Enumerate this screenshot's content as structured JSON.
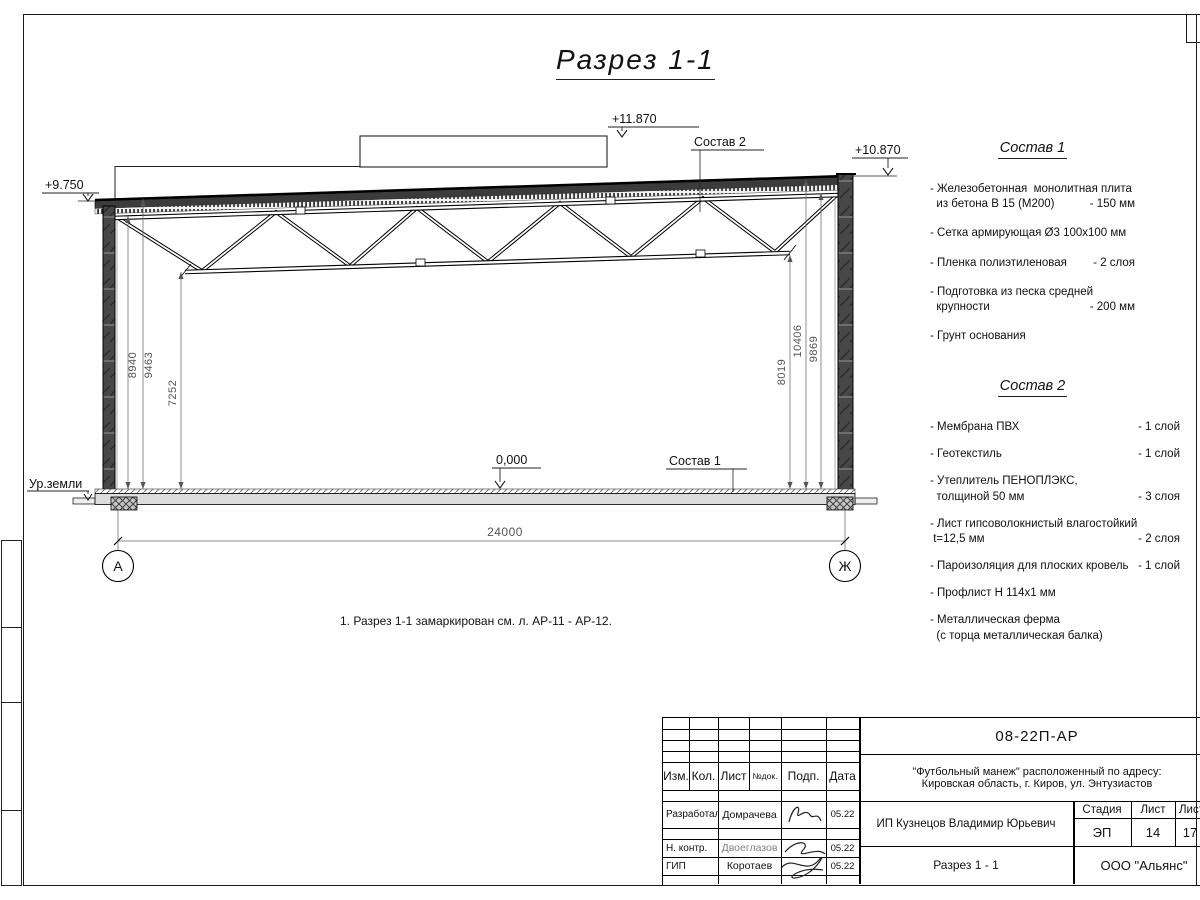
{
  "title": "Разрез 1-1",
  "note": "1. Разрез 1-1 замаркирован см. л. АР-11 - АР-12.",
  "drawing": {
    "elevations": {
      "roof_box": "+11.870",
      "parapet": "+10.870",
      "left_roof": "+9.750",
      "floor": "0,000"
    },
    "labels": {
      "sostav2": "Состав 2",
      "sostav1": "Состав 1",
      "ground": "Ур.земли"
    },
    "dims": {
      "left": [
        "8940",
        "9463",
        "7252"
      ],
      "right": [
        "8019",
        "10406",
        "9869"
      ],
      "span": "24000"
    },
    "axes": {
      "left": "А",
      "right": "Ж"
    }
  },
  "sostav1": {
    "heading": "Состав 1",
    "items": [
      {
        "name": "- Железобетонная  монолитная плита\n  из бетона В 15 (М200)",
        "value": "- 150 мм"
      },
      {
        "name": "- Сетка армирующая Ø3 100x100 мм",
        "value": ""
      },
      {
        "name": "- Пленка полиэтиленовая",
        "value": "-  2 слоя"
      },
      {
        "name": "- Подготовка из песка средней\n  крупности",
        "value": "- 200 мм"
      },
      {
        "name": "- Грунт основания",
        "value": ""
      }
    ]
  },
  "sostav2": {
    "heading": "Состав 2",
    "items": [
      {
        "name": "- Мембрана ПВХ",
        "value": "- 1 слой"
      },
      {
        "name": "- Геотекстиль",
        "value": "- 1 слой"
      },
      {
        "name": "- Утеплитель ПЕНОПЛЭКС,\n  толщиной 50 мм",
        "value": "- 3 слоя"
      },
      {
        "name": "- Лист гипсоволокнистый влагостойкий\n t=12,5 мм",
        "value": "- 2 слоя"
      },
      {
        "name": "- Пароизоляция для плоских кровель",
        "value": "- 1 слой"
      },
      {
        "name": "- Профлист Н 114x1 мм",
        "value": ""
      },
      {
        "name": "- Металлическая ферма\n  (с торца металлическая балка)",
        "value": ""
      }
    ]
  },
  "titleblock": {
    "doc_number": "08-22П-АР",
    "project_line1": "\"Футбольный манеж\" расположенный по адресу:",
    "project_line2": "Кировская область, г. Киров, ул. Энтузиастов",
    "client": "ИП Кузнецов Владимир Юрьевич",
    "sheet_title": "Разрез 1 - 1",
    "company": "ООО \"Альянс\"",
    "header_cols": [
      "Изм.",
      "Кол.",
      "Лист",
      "№док.",
      "Подп.",
      "Дата"
    ],
    "stage_label": "Стадия",
    "sheet_label": "Лист",
    "sheets_label": "Листов",
    "stage": "ЭП",
    "sheet": "14",
    "sheets": "17",
    "rows": [
      {
        "role": "Разработал",
        "name": "Домрачева",
        "date": "05.22"
      },
      {
        "role": "Н. контр.",
        "name": "Двоеглазов",
        "date": "05.22"
      },
      {
        "role": "ГИП",
        "name": "Коротаев",
        "date": "05.22"
      }
    ]
  }
}
